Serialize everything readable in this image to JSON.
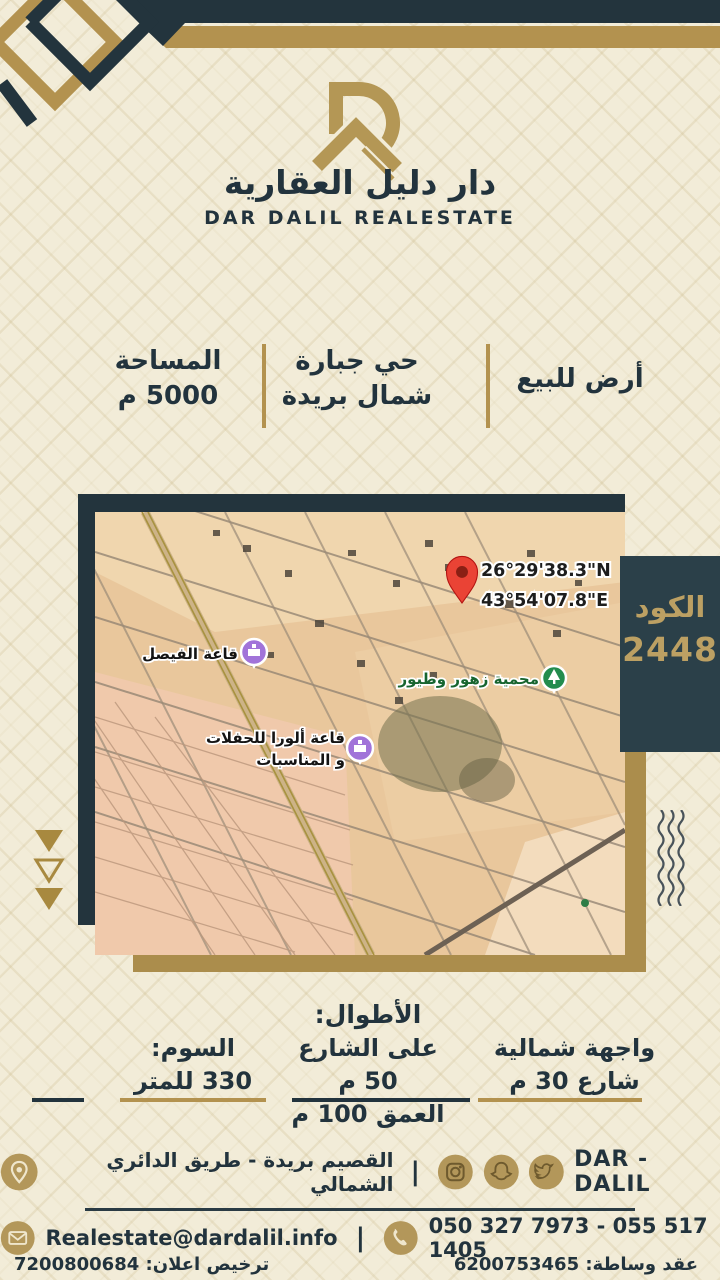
{
  "colors": {
    "navy": "#22333d",
    "gold": "#b3924f",
    "cream": "#f2ecd8",
    "panel_bg": "#2b4049",
    "panel_text": "#bca063",
    "pin_red": "#ea4335",
    "park_green": "#238c4e",
    "venue_purple": "#a173d9"
  },
  "header": {
    "brand_ar": "دار دليل العقارية",
    "brand_en": "DAR DALIL REALESTATE"
  },
  "listing": {
    "sale_type": "أرض للبيع",
    "district_line1": "حي جبارة",
    "district_line2": "شمال بريدة",
    "area_label": "المساحة",
    "area_value": "5000 م"
  },
  "map": {
    "coord_n": "26°29'38.3\"N",
    "coord_e": "43°54'07.8\"E",
    "venue1_label": "قاعة الفيصل",
    "venue2_label_line1": "قاعة ألورا للحفلات",
    "venue2_label_line2": "و المناسبات",
    "reserve_label": "محمية زهور وطيور",
    "code_label": "الكود",
    "code_value": "2448"
  },
  "details": {
    "heading": "الأطوال:",
    "facade_line1": "واجهة شمالية",
    "facade_line2": "شارع 30 م",
    "length_line1": "على الشارع 50 م",
    "length_line2": "العمق 100 م",
    "price_label": "السوم:",
    "price_value": "330 للمتر"
  },
  "footer": {
    "brand": "DAR - DALIL",
    "separator": "|",
    "address": "القصيم بريدة - طريق الدائري الشمالي",
    "email": "Realestate@dardalil.info",
    "phone": "050 327 7973 - 055 517 1405",
    "contract": "عقد وساطة: 6200753465",
    "license": "ترخيص اعلان: 7200800684"
  }
}
